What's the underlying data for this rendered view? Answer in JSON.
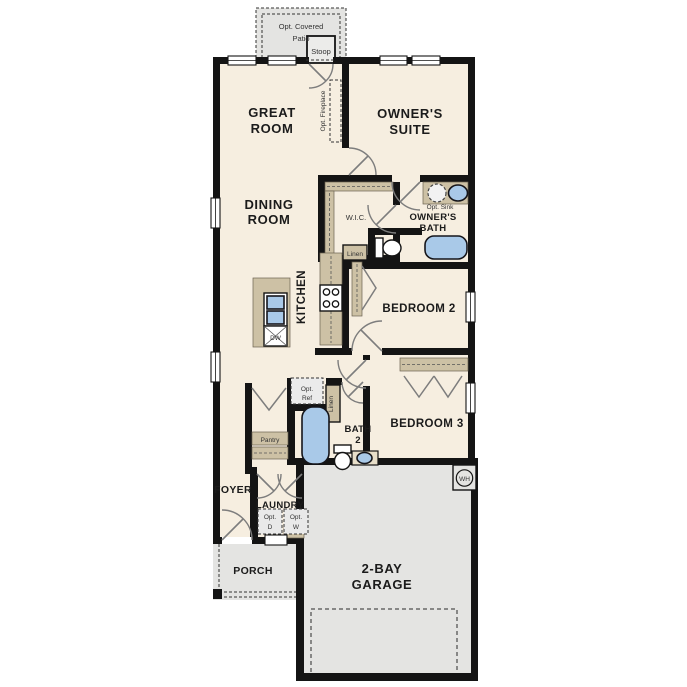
{
  "colors": {
    "floor": "#f6eee0",
    "wall": "#141414",
    "cabinetry": "#cdc1a5",
    "concrete": "#e4e4e2",
    "fixture_blue": "#a9c9e8",
    "door_swing": "#7d7d7d"
  },
  "rooms": {
    "patio": {
      "line1": "Opt. Covered",
      "line2": "Patio"
    },
    "stoop": {
      "label": "Stoop"
    },
    "great_room": {
      "line1": "GREAT",
      "line2": "ROOM"
    },
    "owners_suite": {
      "line1": "OWNER'S",
      "line2": "SUITE"
    },
    "dining_room": {
      "line1": "DINING",
      "line2": "ROOM"
    },
    "wic": {
      "label": "W.I.C."
    },
    "owners_bath": {
      "line1": "OWNER'S",
      "line2": "BATH"
    },
    "kitchen": {
      "label": "KITCHEN"
    },
    "bedroom_2": {
      "label": "BEDROOM 2"
    },
    "bedroom_3": {
      "label": "BEDROOM 3"
    },
    "bath_2": {
      "line1": "BATH",
      "line2": "2"
    },
    "foyer": {
      "label": "FOYER"
    },
    "laundry": {
      "label": "LAUNDRY"
    },
    "porch": {
      "label": "PORCH"
    },
    "garage": {
      "line1": "2-BAY",
      "line2": "GARAGE"
    }
  },
  "features": {
    "opt_fireplace": {
      "label": "Opt. Fireplace"
    },
    "opt_sink": {
      "label": "Opt. Sink"
    },
    "linen_owners": {
      "label": "Linen"
    },
    "linen_hall": {
      "label": "Linen"
    },
    "pantry": {
      "label": "Pantry"
    },
    "opt_ref": {
      "line1": "Opt.",
      "line2": "Ref"
    },
    "opt_dryer": {
      "line1": "Opt.",
      "line2": "D"
    },
    "opt_washer": {
      "line1": "Opt.",
      "line2": "W"
    },
    "dishwasher": {
      "label": "DW"
    },
    "water_heater": {
      "label": "WH"
    }
  }
}
